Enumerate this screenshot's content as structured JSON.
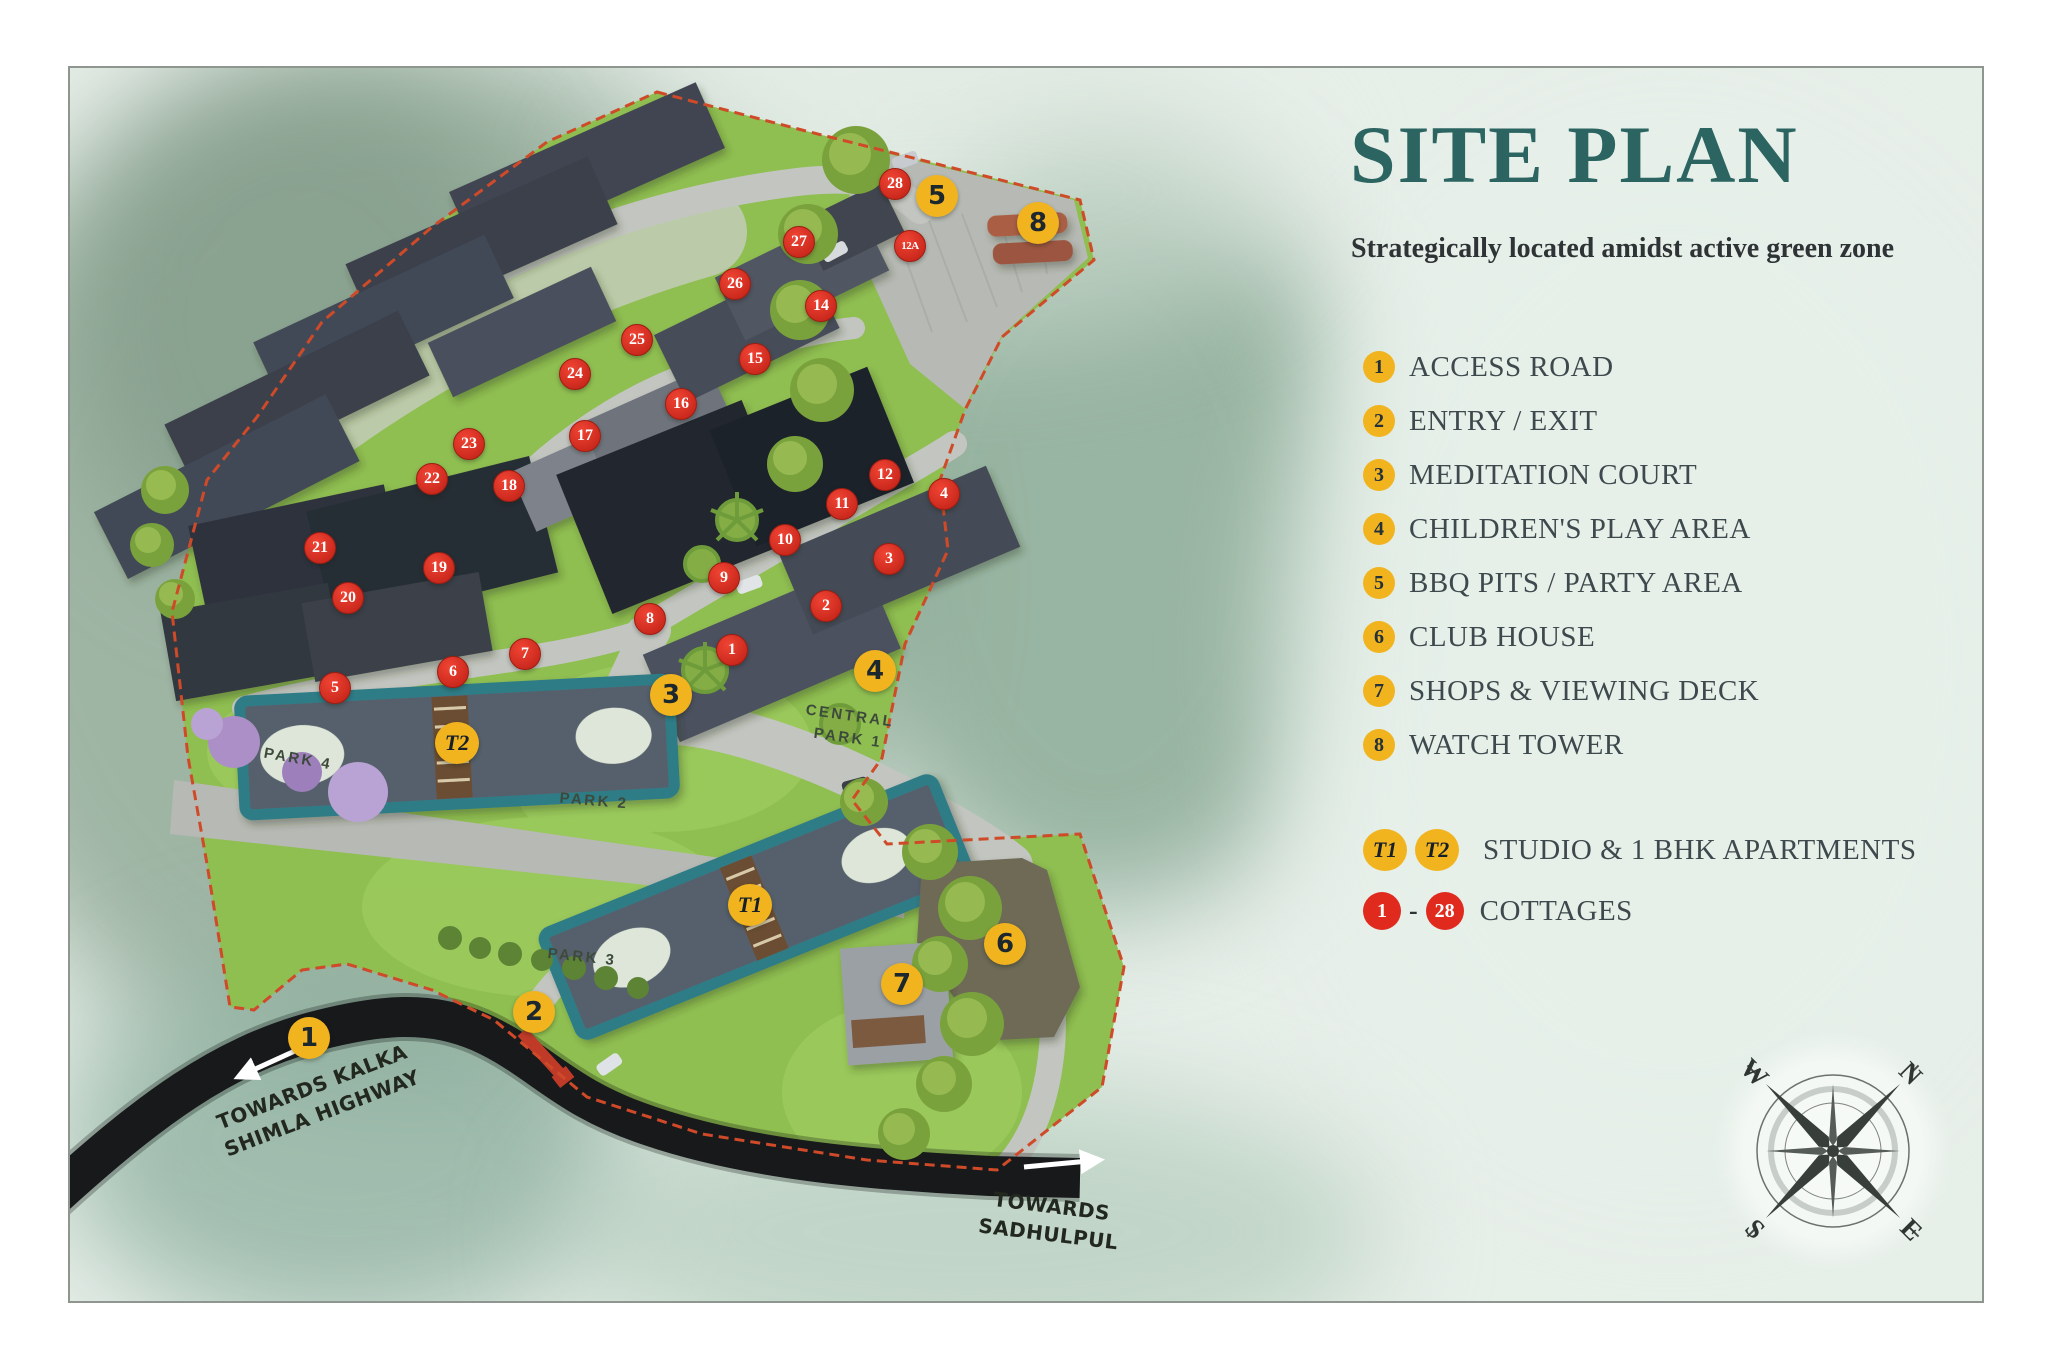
{
  "title": "SITE PLAN",
  "subtitle": "Strategically located amidst active green zone",
  "legend": {
    "items": [
      {
        "num": "1",
        "label": "ACCESS ROAD"
      },
      {
        "num": "2",
        "label": "ENTRY / EXIT"
      },
      {
        "num": "3",
        "label": "MEDITATION COURT"
      },
      {
        "num": "4",
        "label": "CHILDREN'S PLAY AREA"
      },
      {
        "num": "5",
        "label": "BBQ PITS / PARTY AREA"
      },
      {
        "num": "6",
        "label": "CLUB HOUSE"
      },
      {
        "num": "7",
        "label": "SHOPS & VIEWING DECK"
      },
      {
        "num": "8",
        "label": "WATCH TOWER"
      }
    ],
    "apartments": {
      "badge1": "T1",
      "badge2": "T2",
      "label": "STUDIO & 1 BHK APARTMENTS"
    },
    "cottages": {
      "badge_from": "1",
      "dash": "-",
      "badge_to": "28",
      "label": "COTTAGES"
    }
  },
  "map": {
    "amenity_markers": [
      {
        "num": "1",
        "x": 307,
        "y": 1036
      },
      {
        "num": "2",
        "x": 532,
        "y": 1010
      },
      {
        "num": "3",
        "x": 669,
        "y": 693
      },
      {
        "num": "4",
        "x": 873,
        "y": 669
      },
      {
        "num": "5",
        "x": 935,
        "y": 194
      },
      {
        "num": "6",
        "x": 1003,
        "y": 942
      },
      {
        "num": "7",
        "x": 900,
        "y": 982
      },
      {
        "num": "8",
        "x": 1036,
        "y": 221
      }
    ],
    "tower_markers": [
      {
        "num": "T1",
        "x": 748,
        "y": 903
      },
      {
        "num": "T2",
        "x": 455,
        "y": 741
      }
    ],
    "cottage_markers": [
      {
        "num": "1",
        "x": 730,
        "y": 648
      },
      {
        "num": "2",
        "x": 824,
        "y": 604
      },
      {
        "num": "3",
        "x": 887,
        "y": 557
      },
      {
        "num": "4",
        "x": 942,
        "y": 492
      },
      {
        "num": "5",
        "x": 333,
        "y": 686
      },
      {
        "num": "6",
        "x": 451,
        "y": 670
      },
      {
        "num": "7",
        "x": 523,
        "y": 652
      },
      {
        "num": "8",
        "x": 648,
        "y": 617
      },
      {
        "num": "9",
        "x": 722,
        "y": 576
      },
      {
        "num": "10",
        "x": 783,
        "y": 538
      },
      {
        "num": "11",
        "x": 840,
        "y": 502
      },
      {
        "num": "12",
        "x": 883,
        "y": 473
      },
      {
        "num": "12A",
        "x": 908,
        "y": 244
      },
      {
        "num": "14",
        "x": 819,
        "y": 304
      },
      {
        "num": "15",
        "x": 753,
        "y": 357
      },
      {
        "num": "16",
        "x": 679,
        "y": 402
      },
      {
        "num": "17",
        "x": 583,
        "y": 434
      },
      {
        "num": "18",
        "x": 507,
        "y": 484
      },
      {
        "num": "19",
        "x": 437,
        "y": 566
      },
      {
        "num": "20",
        "x": 346,
        "y": 596
      },
      {
        "num": "21",
        "x": 318,
        "y": 546
      },
      {
        "num": "22",
        "x": 430,
        "y": 477
      },
      {
        "num": "23",
        "x": 467,
        "y": 442
      },
      {
        "num": "24",
        "x": 573,
        "y": 372
      },
      {
        "num": "25",
        "x": 635,
        "y": 338
      },
      {
        "num": "26",
        "x": 733,
        "y": 282
      },
      {
        "num": "27",
        "x": 797,
        "y": 240
      },
      {
        "num": "28",
        "x": 893,
        "y": 182
      }
    ],
    "park_labels": [
      {
        "text": "PARK 4",
        "x": 296,
        "y": 757,
        "rot": 10
      },
      {
        "text": "PARK 2",
        "x": 592,
        "y": 799,
        "rot": 5
      },
      {
        "text": "PARK 3",
        "x": 580,
        "y": 955,
        "rot": 6
      },
      {
        "text": "CENTRAL",
        "x": 848,
        "y": 714,
        "rot": 8
      },
      {
        "text": "PARK 1",
        "x": 846,
        "y": 736,
        "rot": 8
      }
    ],
    "road_labels": [
      {
        "lines": [
          "TOWARDS KALKA",
          "SHIMLA HIGHWAY"
        ],
        "x": 315,
        "y": 1098,
        "rot": -21
      },
      {
        "lines": [
          "TOWARDS",
          "SADHULPUL"
        ],
        "x": 1048,
        "y": 1218,
        "rot": 7
      }
    ]
  },
  "compass": {
    "n": "N",
    "e": "E",
    "s": "S",
    "w": "W"
  },
  "colors": {
    "title_teal": "#2B6461",
    "subtitle_dark": "#2E3335",
    "legend_text": "#3E494D",
    "badge_yellow": "#F2B41E",
    "badge_red": "#E02A1E",
    "lawn_green": "#8FBE51",
    "boundary_red": "#CF4A28",
    "highway_dark": "#17191B",
    "road_grey": "#C3C6C0",
    "roof_dark": "#3F4551",
    "apartment_teal": "#2E7B86"
  }
}
